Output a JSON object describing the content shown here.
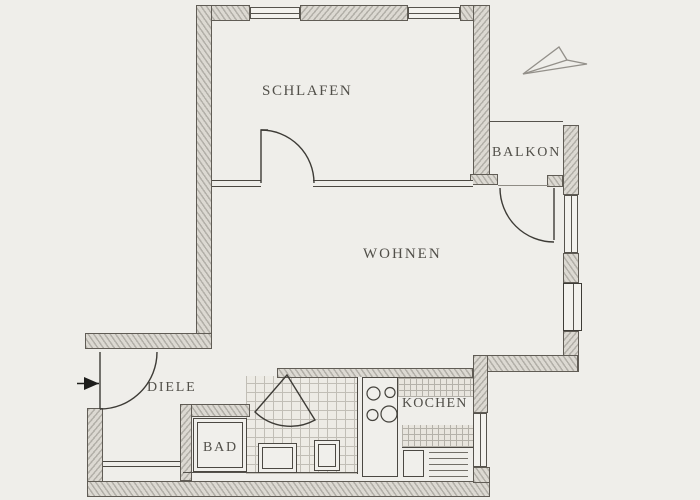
{
  "title": "Hand-drawn apartment floor plan",
  "colors": {
    "paper": "#efeeea",
    "wall_hatch": "#b2afa8",
    "outline": "#4b4842",
    "label_text": "#44423c"
  },
  "rooms": {
    "schlafen": {
      "label": "SCHLAFEN"
    },
    "balkon": {
      "label": "BALKON"
    },
    "wohnen": {
      "label": "WOHNEN"
    },
    "diele": {
      "label": "DIELE"
    },
    "bad": {
      "label": "BAD"
    },
    "kochen": {
      "label": "KOCHEN"
    }
  },
  "annotations": {
    "north_arrow": "hand-sketched arrow, top right",
    "entrance_marker": "black arrow at entry door, left side"
  }
}
